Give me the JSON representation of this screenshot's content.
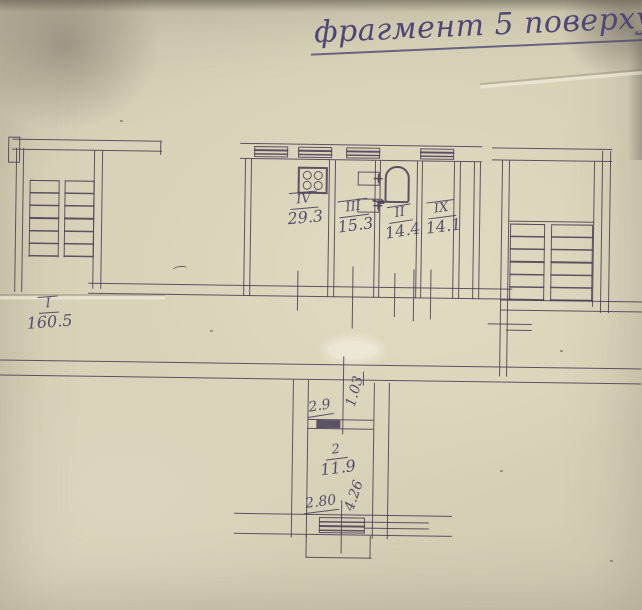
{
  "title": "фрагмент 5 поверху",
  "rooms": {
    "r1": {
      "number": "I",
      "area": "160.5"
    },
    "r4": {
      "number": "IV",
      "area": "29.3"
    },
    "r3": {
      "number": "III",
      "area": "15.3"
    },
    "r2i": {
      "number": "II",
      "area": "14.4"
    },
    "r9": {
      "number": "IX",
      "area": "14.1"
    },
    "r2": {
      "number": "2",
      "area": "11.9"
    }
  },
  "dimensions": {
    "vest_width": "2.9",
    "vest_depth": "1.03",
    "balc_depth": "4.26",
    "balc_width": "2.80"
  },
  "colors": {
    "ink": "rgba(74,64,88,0.88)",
    "hand": "rgba(74,67,102,0.92)",
    "title_ink": "#4e4775",
    "paper": "#d8d2b8"
  },
  "icons": [
    "stove-icon",
    "sink-icon",
    "bathtub-icon",
    "stairs-icon",
    "window-icon",
    "door-swing-arrow-icon"
  ]
}
